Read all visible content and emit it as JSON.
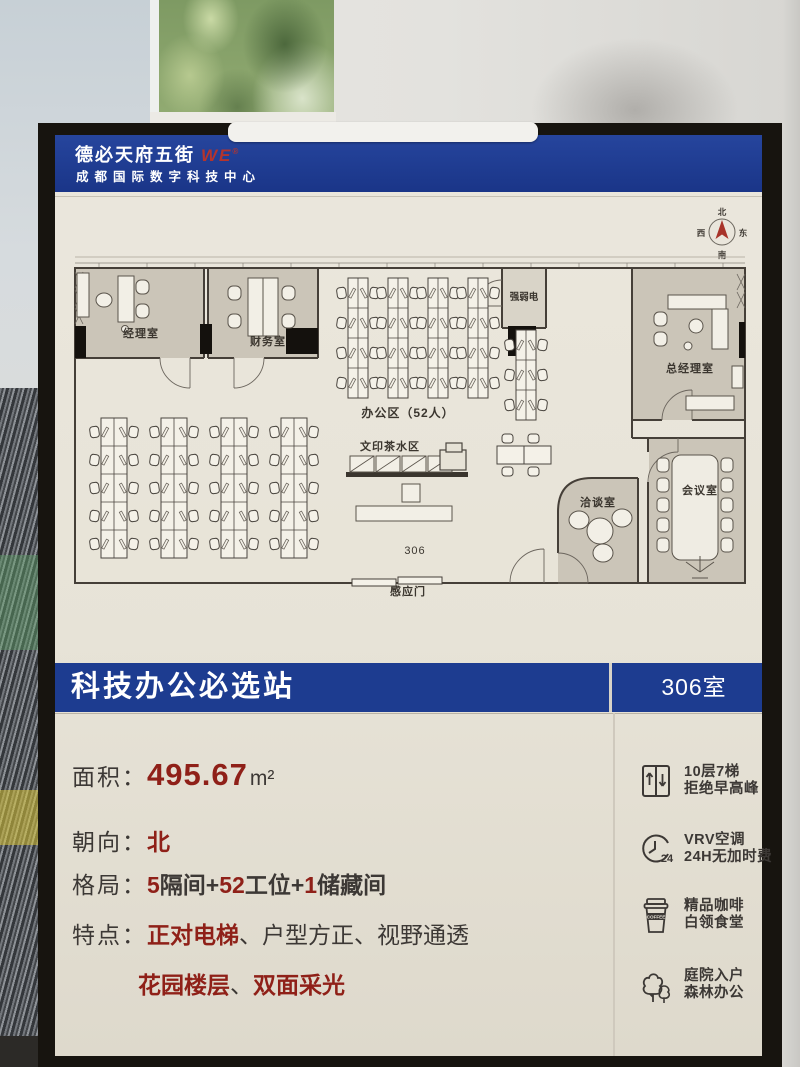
{
  "header": {
    "brand": "德必天府五街",
    "logo": "WE",
    "reg": "®",
    "subtitle": "成都国际数字科技中心"
  },
  "compass": {
    "n": "北",
    "s": "南",
    "e": "东",
    "w": "西"
  },
  "floorplan": {
    "labels": {
      "manager": "经理室",
      "finance": "财务室",
      "utility": "强弱电",
      "general_manager": "总经理室",
      "meeting": "会议室",
      "negotiation": "洽谈室",
      "office_area": "办公区（52人）",
      "print_tea": "文印茶水区",
      "room_number": "306",
      "sensor_door": "感应门"
    }
  },
  "banner": {
    "title": "科技办公必选站",
    "room": "306室"
  },
  "details": {
    "area": {
      "label": "面积：",
      "value": "495.67",
      "unit": "m²"
    },
    "orientation": {
      "label": "朝向：",
      "value": "北"
    },
    "layout": {
      "label": "格局：",
      "n1": "5",
      "t1": "隔间+",
      "n2": "52",
      "t2": "工位+",
      "n3": "1",
      "t3": "储藏间"
    },
    "features": {
      "label": "特点：",
      "f1": "正对电梯",
      "d1": "、",
      "f2": "户型方正",
      "d2": "、",
      "f3": "视野通透",
      "f4": "花园楼层",
      "d3": "、",
      "f5": "双面采光"
    }
  },
  "sidebar": {
    "items": [
      {
        "line1": "10层7梯",
        "line2": "拒绝早高峰"
      },
      {
        "line1": "VRV空调",
        "line2": "24H无加时费"
      },
      {
        "line1": "精品咖啡",
        "line2": "白领食堂"
      },
      {
        "line1": "庭院入户",
        "line2": "森林办公"
      }
    ],
    "coffee_label": "COFFEE",
    "clock_label": "24"
  }
}
